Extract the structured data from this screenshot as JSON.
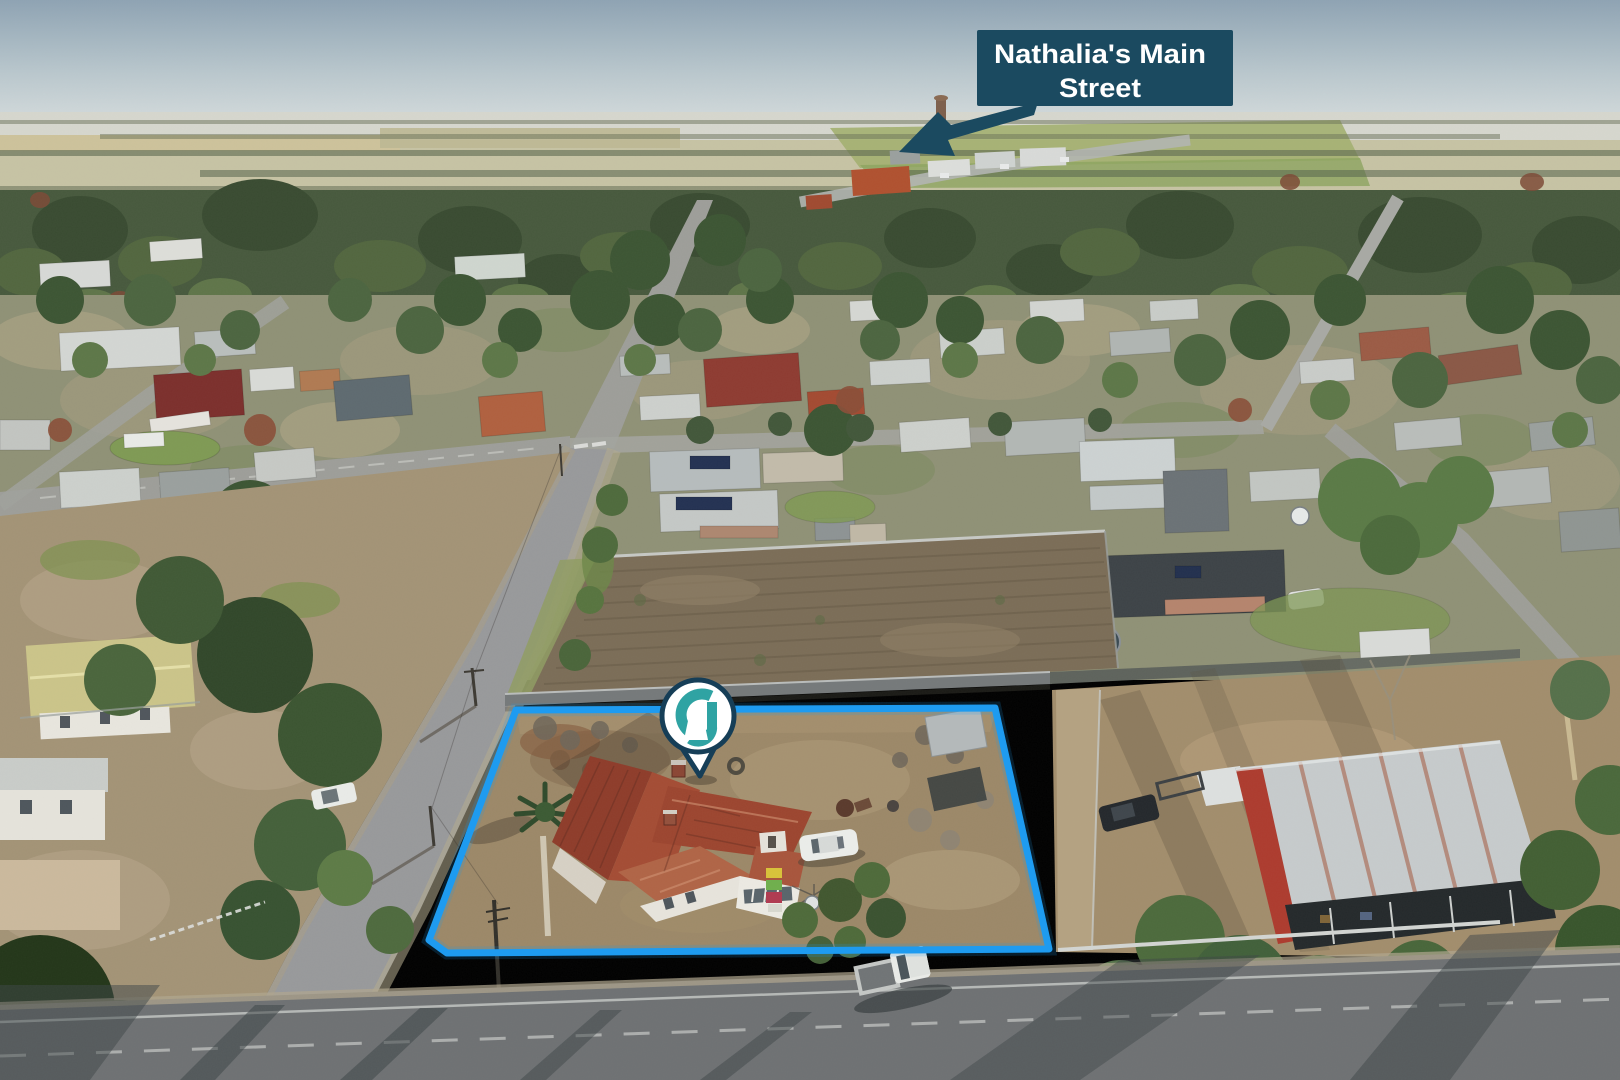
{
  "annotation": {
    "label": {
      "line1": "Nathalia's Main",
      "line2": "Street"
    }
  },
  "icons": {
    "label_arrow": "arrow-down-left",
    "marker": "brand-keyhole-location-pin"
  },
  "colors": {
    "boundary": "#1e9bf0",
    "label_bg": "#1b4a60",
    "label_text": "#ffffff",
    "pin_outline": "#163e57",
    "pin_fill": "#ffffff",
    "pin_glyph": "#2fa3a3"
  }
}
